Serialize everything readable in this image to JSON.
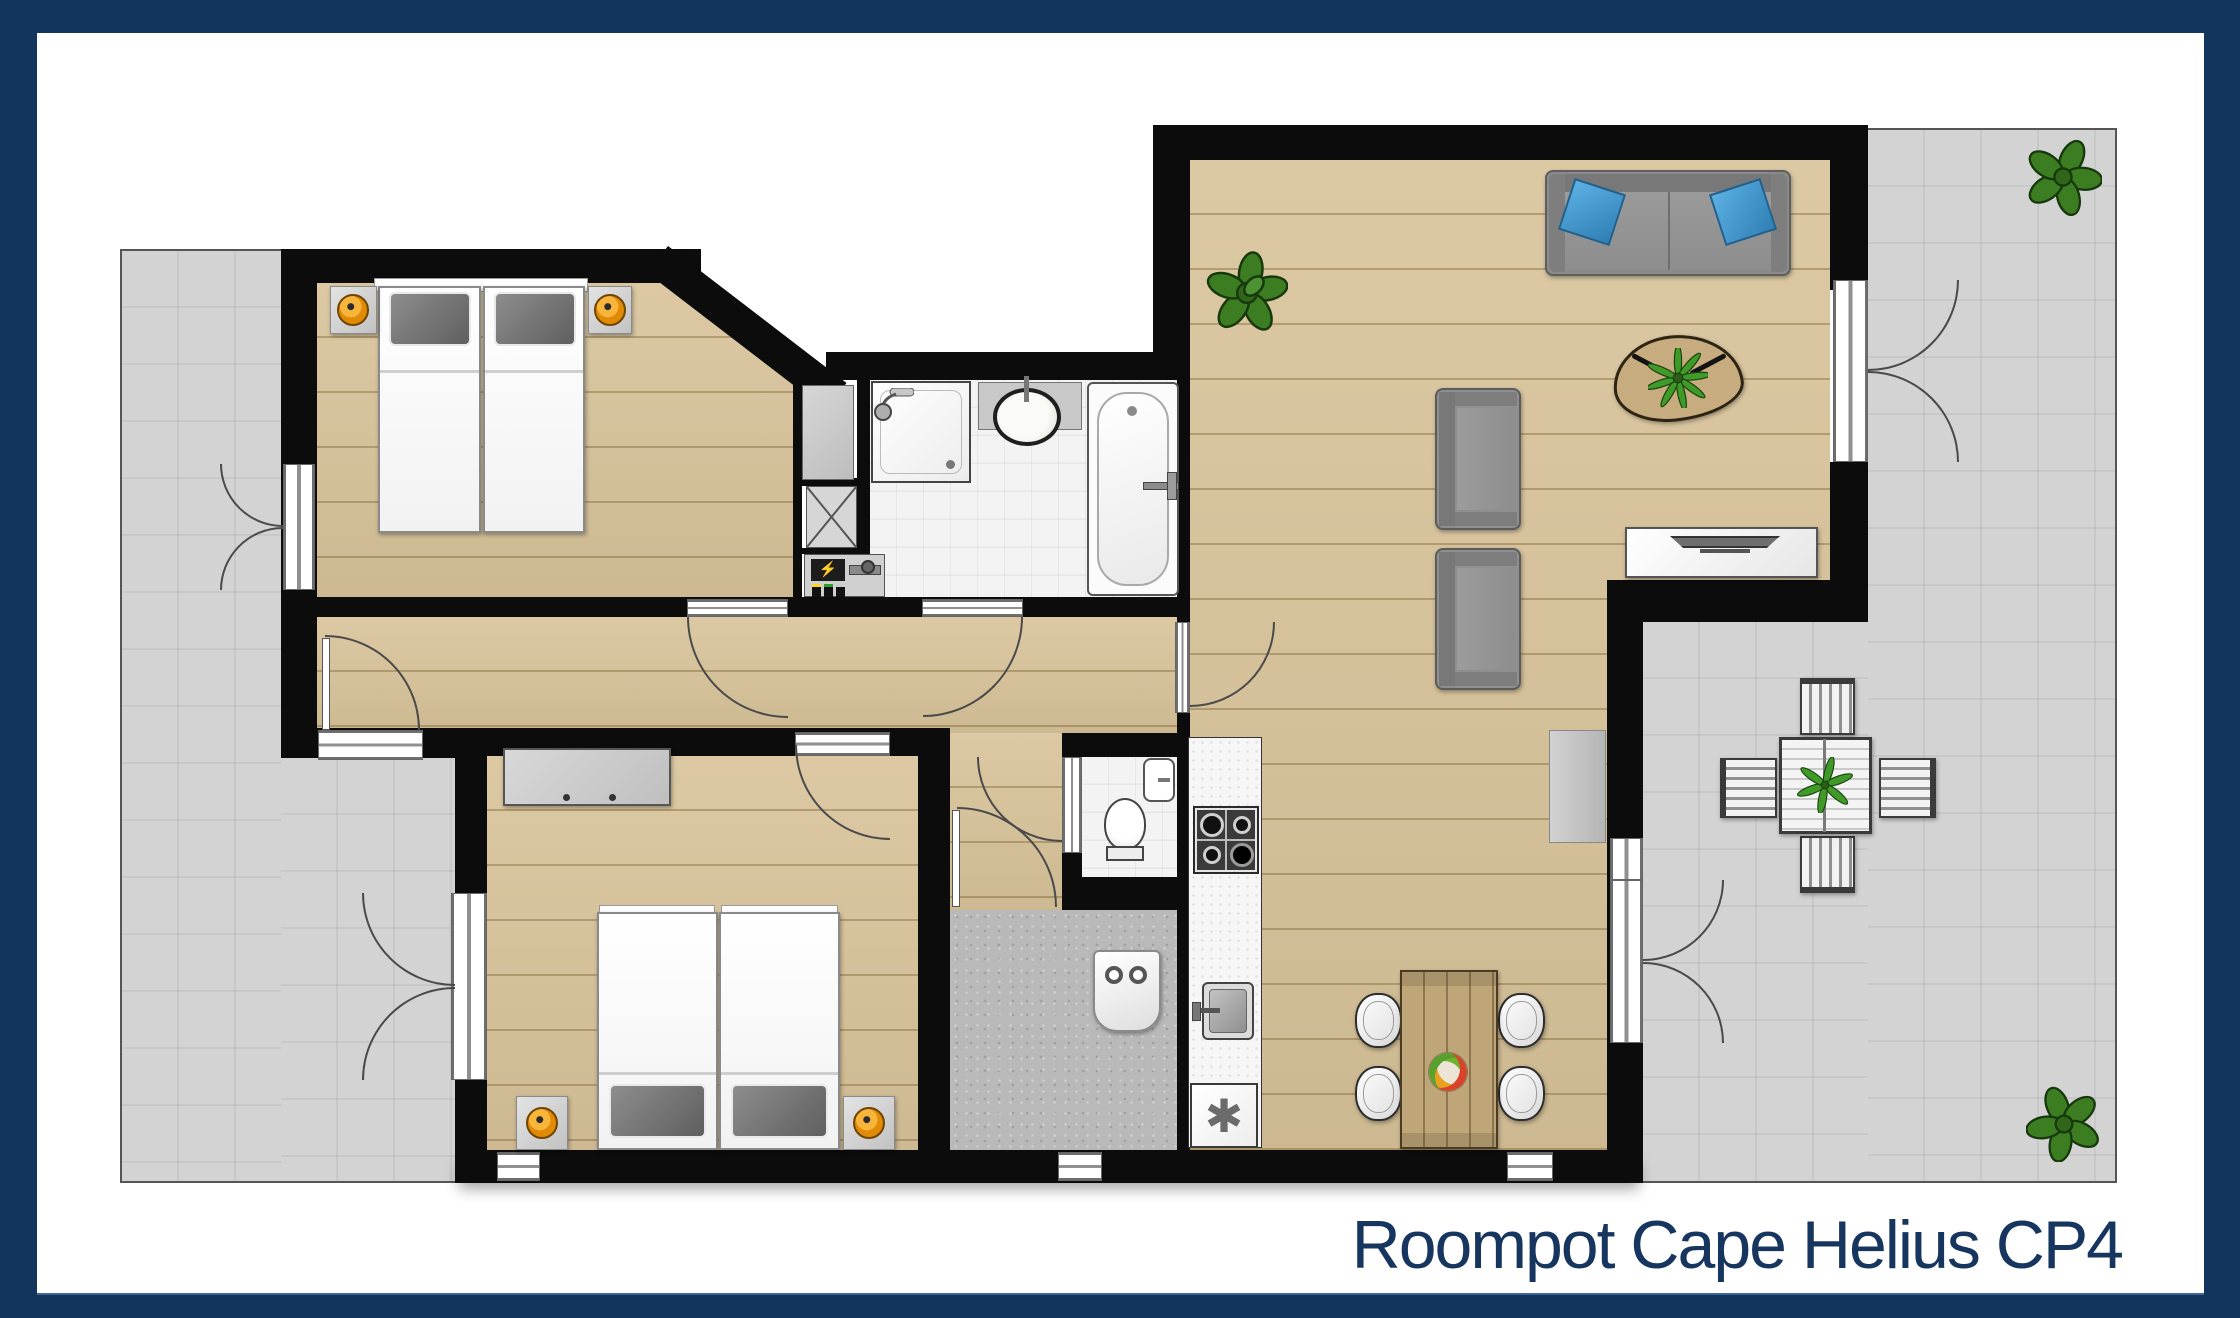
{
  "title": {
    "text": "Roompot Cape Helius CP4",
    "color": "#16365f"
  },
  "frame": {
    "border_color": "#12355e",
    "inner_background": "#ffffff"
  },
  "symbols": {
    "freezer": "✱",
    "electric_meter": "⚡"
  },
  "palette": {
    "wall": "#0c0c0c",
    "wood_floor": "#d8c399",
    "terrace_tile": "#d3d3d3",
    "bathroom_tile": "#f3f3f3",
    "hall_concrete": "#b9b9b9",
    "pillow_blue": "#3e96cf",
    "lamp_orange": "#e8940a",
    "plant_green": "#3c7d22",
    "sofa_gray": "#8a8a8a",
    "dining_table_wood": "#bfa678",
    "title_navy": "#16365f"
  }
}
